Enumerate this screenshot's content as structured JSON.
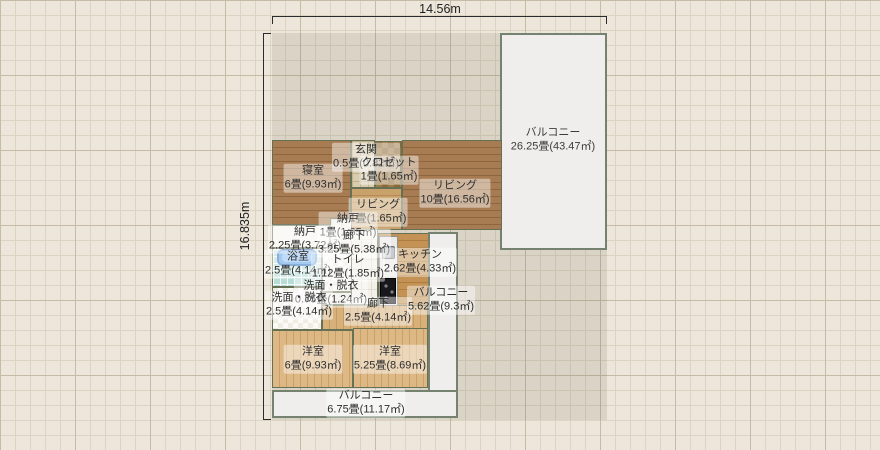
{
  "dimensions": {
    "width_label": "14.56m",
    "height_label": "16.835m"
  },
  "rooms": [
    {
      "name": "寝室",
      "area": "6畳(9.93㎡)"
    },
    {
      "name": "玄関",
      "area": "0.5畳(0.82㎡)"
    },
    {
      "name": "クロゼット",
      "area": "1畳(1.65㎡)"
    },
    {
      "name": "リビング",
      "area": "10畳(16.56㎡)"
    },
    {
      "name": "リビング",
      "area": "1畳(1.65㎡)"
    },
    {
      "name": "納戸",
      "area": "2.25畳(3.72㎡)"
    },
    {
      "name": "納戸",
      "area": "1畳(1.65㎡)"
    },
    {
      "name": "廊下",
      "area": "3.25畳(5.38㎡)"
    },
    {
      "name": "浴室",
      "area": "2.5畳(4.14㎡)"
    },
    {
      "name": "トイレ",
      "area": "1.12畳(1.85㎡)"
    },
    {
      "name": "キッチン",
      "area": "2.62畳(4.33㎡)"
    },
    {
      "name": "洗面・脱衣",
      "area": "0.75畳(1.24㎡)"
    },
    {
      "name": "洗面・脱衣",
      "area": "2.5畳(4.14㎡)"
    },
    {
      "name": "廊下",
      "area": "2.5畳(4.14㎡)"
    },
    {
      "name": "バルコニー",
      "area": "5.62畳(9.3㎡)"
    },
    {
      "name": "洋室",
      "area": "6畳(9.93㎡)"
    },
    {
      "name": "洋室",
      "area": "5.25畳(8.69㎡)"
    },
    {
      "name": "バルコニー",
      "area": "6.75畳(11.17㎡)"
    },
    {
      "name": "バルコニー",
      "area": "26.25畳(43.47㎡)"
    }
  ],
  "icons": [
    "bathtub-icon",
    "kitchen-sink-icon",
    "stove-icon"
  ],
  "colors": {
    "grid_bg": "#ede7db",
    "lot_shade": "rgba(95,82,60,0.13)",
    "wood_floor": "#a87c52",
    "light_wood_floor": "#ddb784",
    "kitchen_floor": "#c49254",
    "bath_tile": "#b7ddd6",
    "balcony": "#efeeec",
    "wall": "#667055",
    "bathtub_blue": "#5a9fe8"
  }
}
